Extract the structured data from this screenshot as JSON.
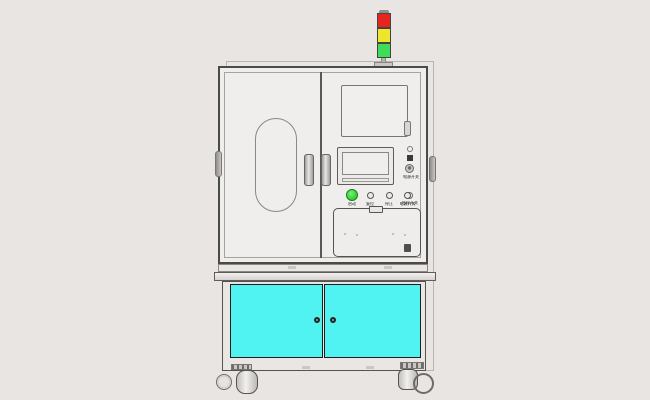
{
  "meta": {
    "title": "Industrial automation equipment cabinet - front view CAD render"
  },
  "colors": {
    "background": "#e8e5e2",
    "cabinet_fill": "#f0eeec",
    "door_cyan": "#50f2f2",
    "lamp_red": "#e62420",
    "lamp_yellow": "#efe52e",
    "lamp_green": "#3fdc5a",
    "button_green": "#35d435",
    "knob_dark": "#242422"
  },
  "tower_light": {
    "segments": [
      "red",
      "yellow",
      "green"
    ]
  },
  "control_panel": {
    "buttons": [
      {
        "label": "启动",
        "color": "#35d435"
      },
      {
        "label": "复位"
      },
      {
        "label": "停止"
      },
      {
        "label": "电源开关"
      }
    ],
    "side_controls": [
      {
        "label": "电源开关"
      },
      {
        "label": "急停开关"
      }
    ]
  },
  "lower_cabinet": {
    "doors": 2,
    "door_color": "#50f2f2"
  }
}
